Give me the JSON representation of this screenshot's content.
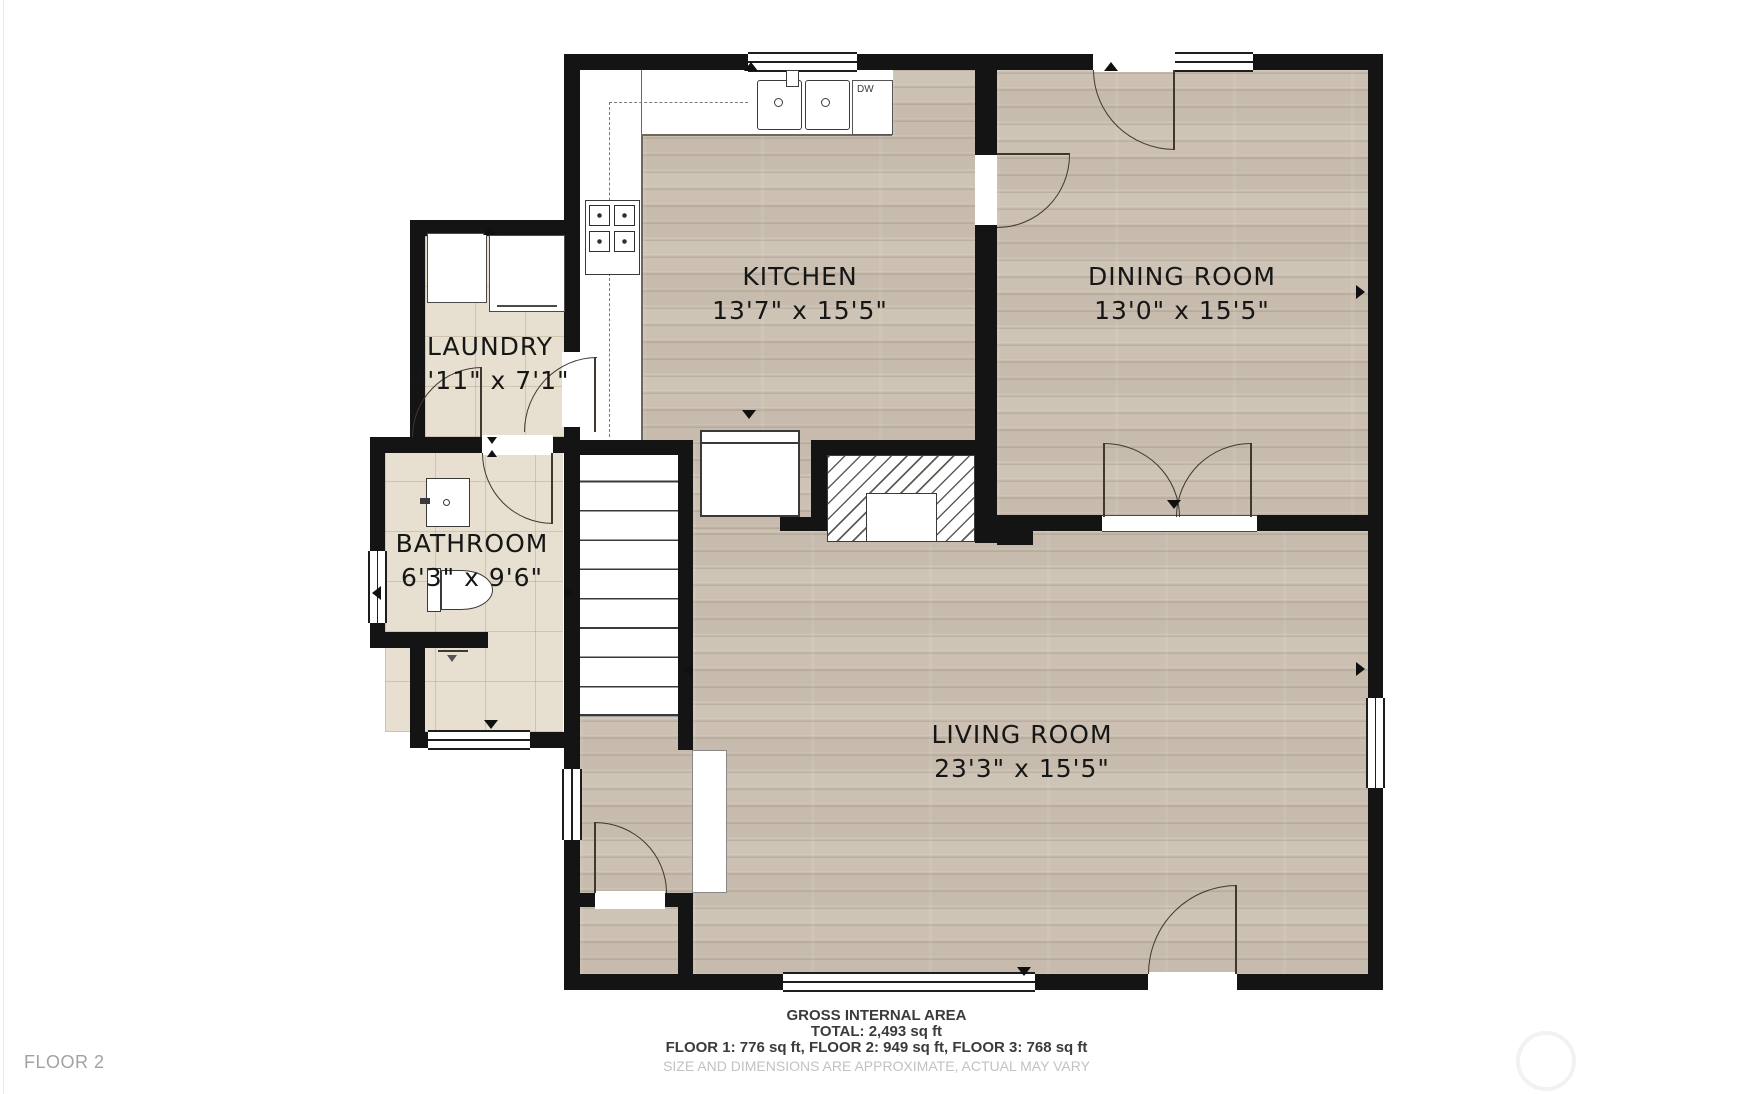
{
  "rooms": {
    "kitchen": {
      "name": "KITCHEN",
      "dims": "13'7\" x 15'5\""
    },
    "dining": {
      "name": "DINING ROOM",
      "dims": "13'0\" x 15'5\""
    },
    "laundry": {
      "name": "LAUNDRY",
      "dims": "4'11\" x 7'1\""
    },
    "bathroom": {
      "name": "BATHROOM",
      "dims": "6'3\" x 9'6\""
    },
    "living": {
      "name": "LIVING ROOM",
      "dims": "23'3\" x 15'5\""
    }
  },
  "appliances": {
    "dishwasher": "DW"
  },
  "footer": {
    "line1": "GROSS INTERNAL AREA",
    "line2": "TOTAL: 2,493 sq ft",
    "line3": "FLOOR 1: 776 sq ft, FLOOR 2: 949 sq ft, FLOOR 3: 768 sq ft",
    "disclaimer": "SIZE AND DIMENSIONS ARE APPROXIMATE, ACTUAL MAY VARY"
  },
  "floor_label": "FLOOR 2",
  "colors": {
    "wall": "#141414",
    "wood_floor": "#cbc0b2",
    "tile_floor": "#e7dfcf",
    "background": "#ffffff"
  }
}
